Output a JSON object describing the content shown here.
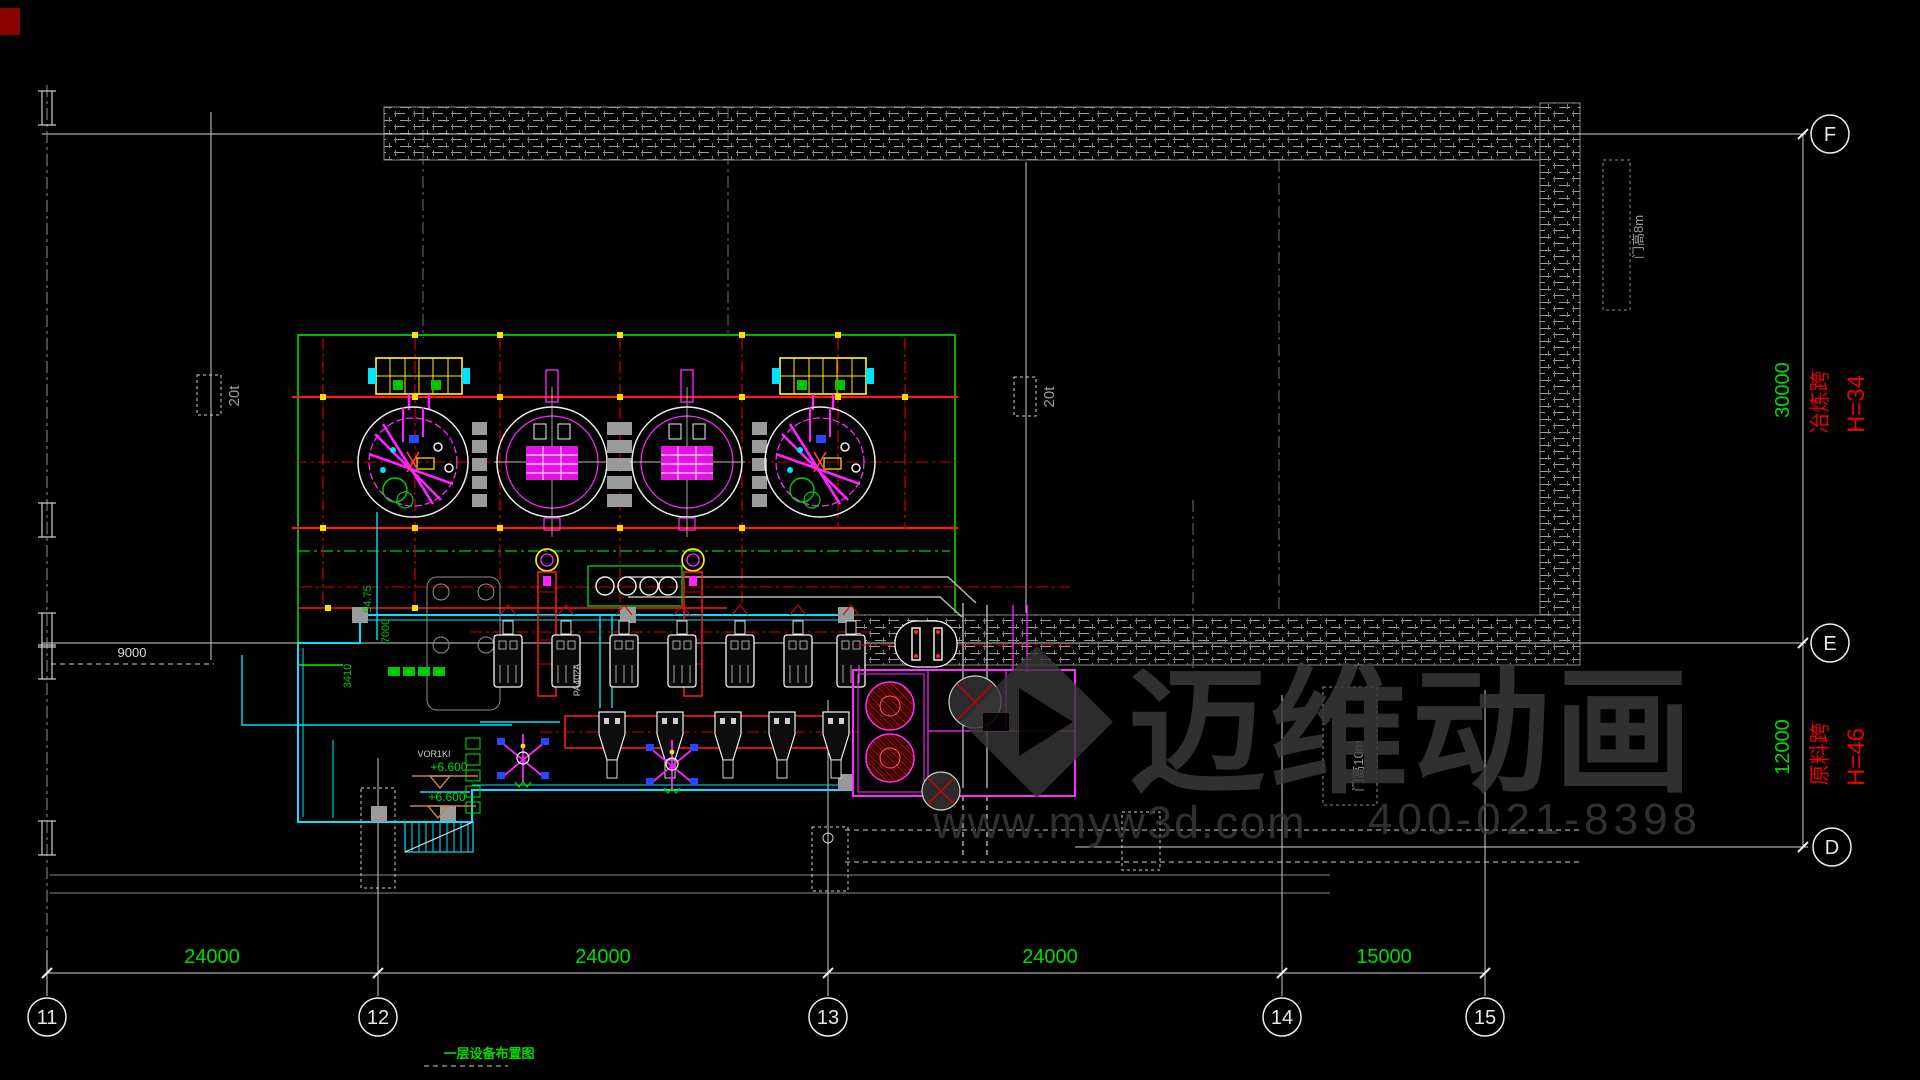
{
  "watermark": {
    "brand": "迈维动画",
    "url": "www.myw3d.com",
    "phone": "400-021-8398"
  },
  "grid": {
    "columns": [
      {
        "label": "11"
      },
      {
        "label": "12"
      },
      {
        "label": "13"
      },
      {
        "label": "14"
      },
      {
        "label": "15"
      }
    ],
    "rows": [
      {
        "label": "F"
      },
      {
        "label": "E"
      },
      {
        "label": "D"
      }
    ]
  },
  "dimensions": {
    "bottom": [
      {
        "text": "24000"
      },
      {
        "text": "24000"
      },
      {
        "text": "24000"
      },
      {
        "text": "15000"
      }
    ],
    "right": [
      {
        "text": "30000"
      },
      {
        "text": "12000"
      }
    ],
    "aux": {
      "d9000": "9000",
      "d7000": "7000",
      "d5475": "54.75",
      "d3410": "3410"
    }
  },
  "bays": [
    {
      "name": "冶炼跨",
      "height": "H=34"
    },
    {
      "name": "原料跨",
      "height": "H=46"
    }
  ],
  "annotations": {
    "crane_a": "20t",
    "crane_b": "20t",
    "door_top": "门高8m",
    "door_mid": "门高10m",
    "level_a": "+6.600",
    "level_b": "+6.600",
    "room_tag": "VOR1KI",
    "equip_tag": "PA402A"
  },
  "title": {
    "text": "一层设备布置图"
  }
}
